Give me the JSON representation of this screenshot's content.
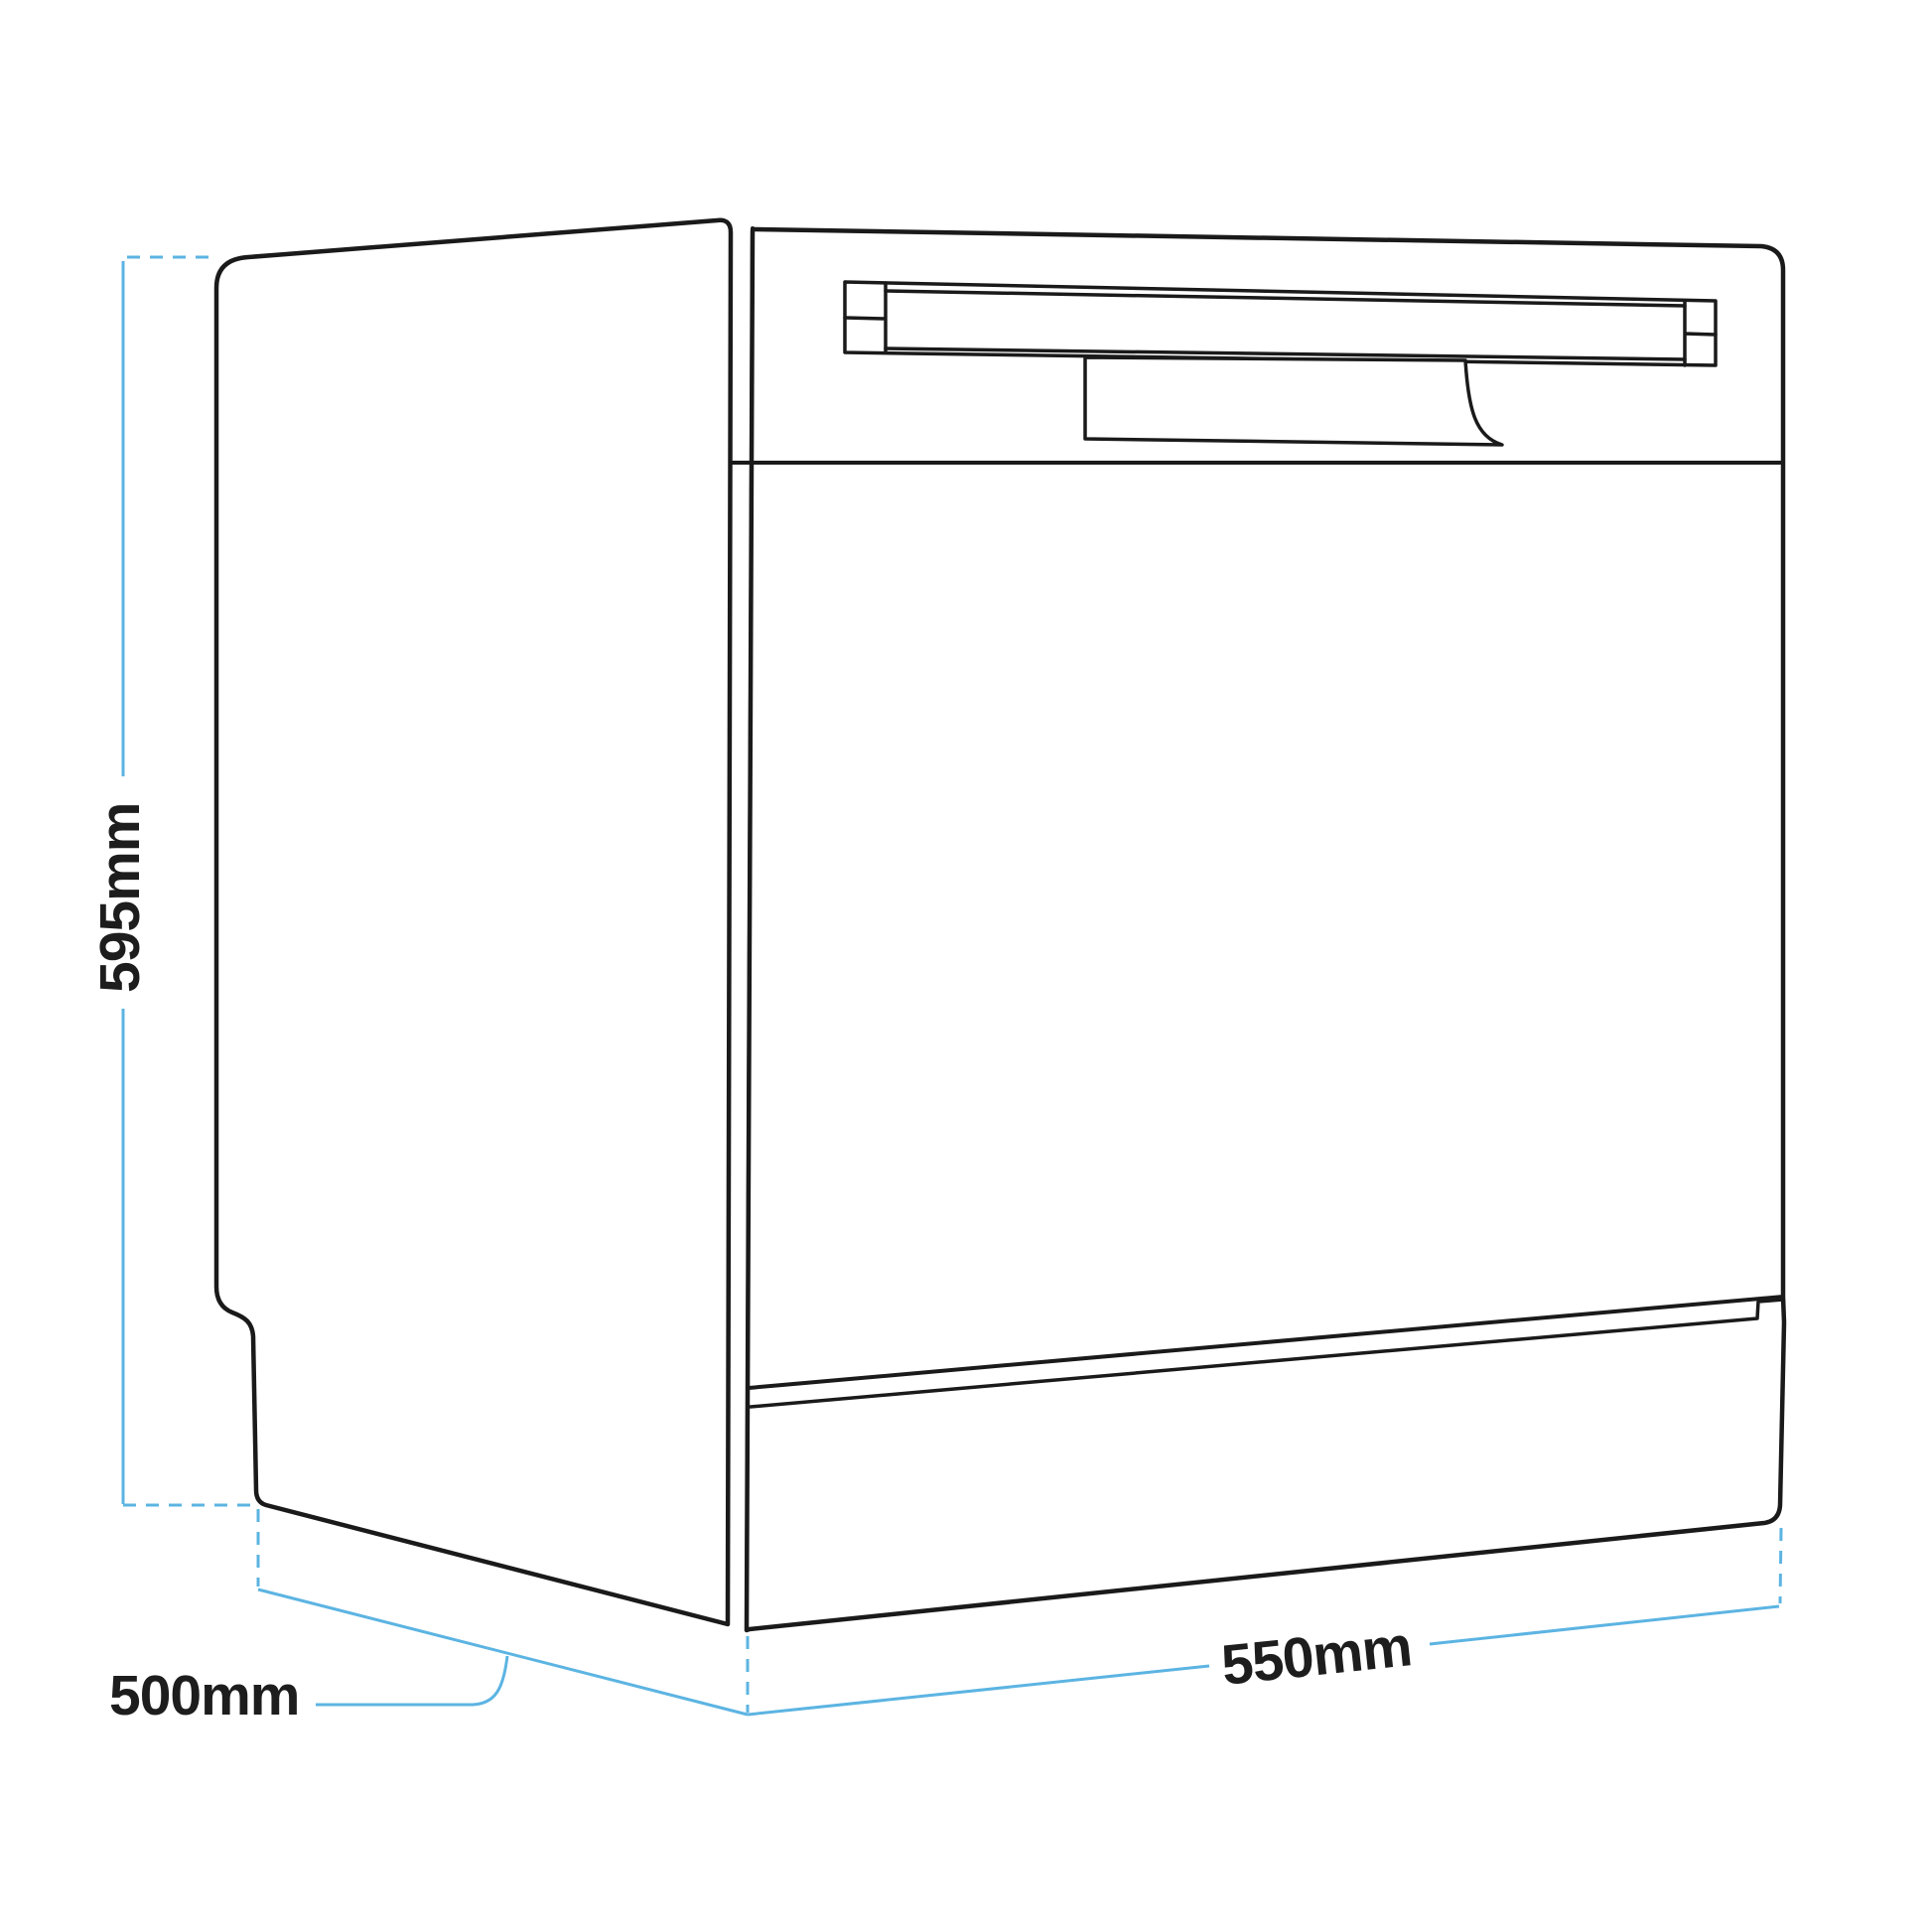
{
  "diagram": {
    "dimensions": {
      "height": {
        "label": "595mm"
      },
      "depth": {
        "label": "500mm"
      },
      "width": {
        "label": "550mm"
      }
    },
    "colors": {
      "outline": "#1a1a1a",
      "dimension_line": "#5cb4e2",
      "label_text": "#1d1d1d"
    }
  }
}
